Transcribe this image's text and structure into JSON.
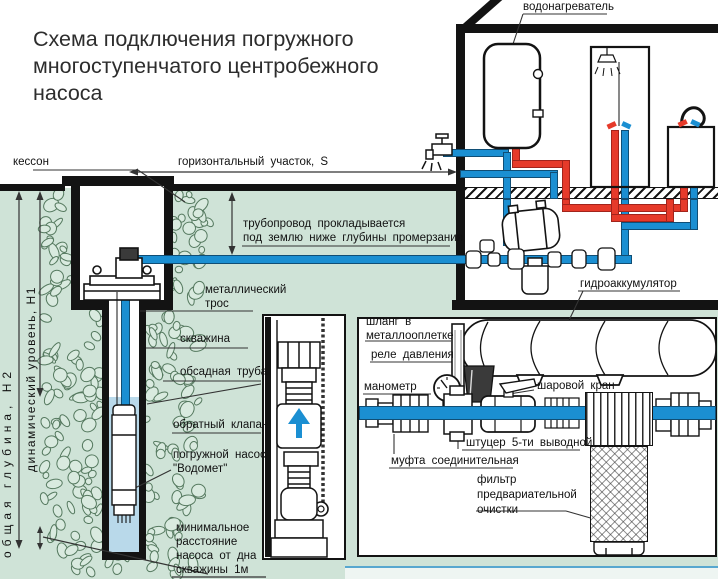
{
  "title": {
    "line1": "Схема подключения погружного",
    "line2": "многоступенчатого центробежного",
    "line3": "насоса"
  },
  "labels": {
    "kesson": "кессон",
    "horizontal_section": "горизонтальный участок, S",
    "water_heater": "водонагреватель",
    "total_depth": "общая глубина, Н2",
    "dynamic_level": "динамический уровень, Н1",
    "pipeline_note_1": "трубопровод прокладывается",
    "pipeline_note_2": "под землю ниже глубины промерзания",
    "metal_cable_1": "металлический",
    "metal_cable_2": "трос",
    "well": "скважина",
    "casing": "обсадная труба",
    "check_valve": "обратный клапан",
    "pump_1": "погружной насос",
    "pump_2": "\"Водомет\"",
    "min_distance_1": "минимальное",
    "min_distance_2": "расстояние",
    "min_distance_3": "насоса от дна",
    "min_distance_4": "скважины 1м",
    "hydroaccumulator": "гидроаккумулятор",
    "hose_1": "шланг в",
    "hose_2": "металлооплетке",
    "pressure_relay": "реле давления",
    "manometer": "манометр",
    "ball_valve": "шаровой кран",
    "fitting5": "штуцер 5-ти выводной",
    "coupling": "муфта соединительная",
    "prefilter_1": "фильтр",
    "prefilter_2": "предвариательной",
    "prefilter_3": "очистки"
  },
  "colors": {
    "pipe_blue": "#1b8fd2",
    "pipe_red": "#e63a2a",
    "ground_green": "#cfe3d7",
    "water_blue": "#b9d9ea",
    "line_black": "#131313"
  }
}
